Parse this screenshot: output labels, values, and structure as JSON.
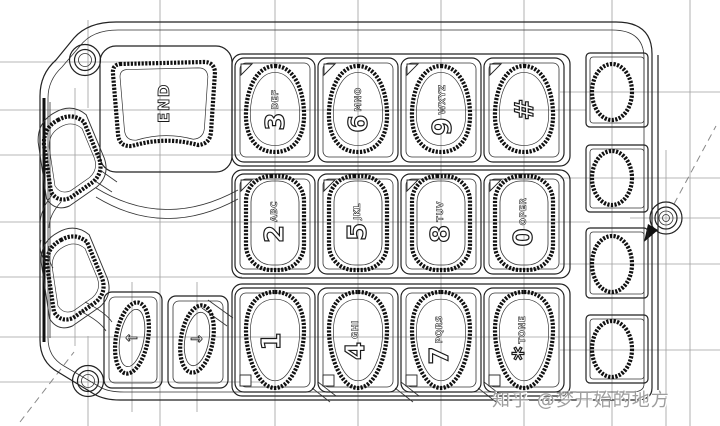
{
  "watermark": {
    "text": "知乎 @梦开始的地方"
  },
  "keypad": {
    "end_key": {
      "label": "END"
    },
    "main_keys": [
      {
        "number": "3",
        "letters": "DEF"
      },
      {
        "number": "6",
        "letters": "MNO"
      },
      {
        "number": "9",
        "letters": "WXYZ"
      },
      {
        "number": "#",
        "letters": ""
      },
      {
        "number": "2",
        "letters": "ABC"
      },
      {
        "number": "5",
        "letters": "JKL"
      },
      {
        "number": "8",
        "letters": "TUV"
      },
      {
        "number": "0",
        "letters": "OPER"
      },
      {
        "number": "1",
        "letters": ""
      },
      {
        "number": "4",
        "letters": "GHI"
      },
      {
        "number": "7",
        "letters": "PQRS"
      },
      {
        "number": "*",
        "letters": "TONE"
      }
    ],
    "nav_keys": [
      {
        "glyph": "↑"
      },
      {
        "glyph": "↓"
      }
    ]
  },
  "colors": {
    "line": "#1a1a1a",
    "grid": "#9f9f9f",
    "watermark_gray": "#9e9e9e",
    "background": "#ffffff"
  }
}
